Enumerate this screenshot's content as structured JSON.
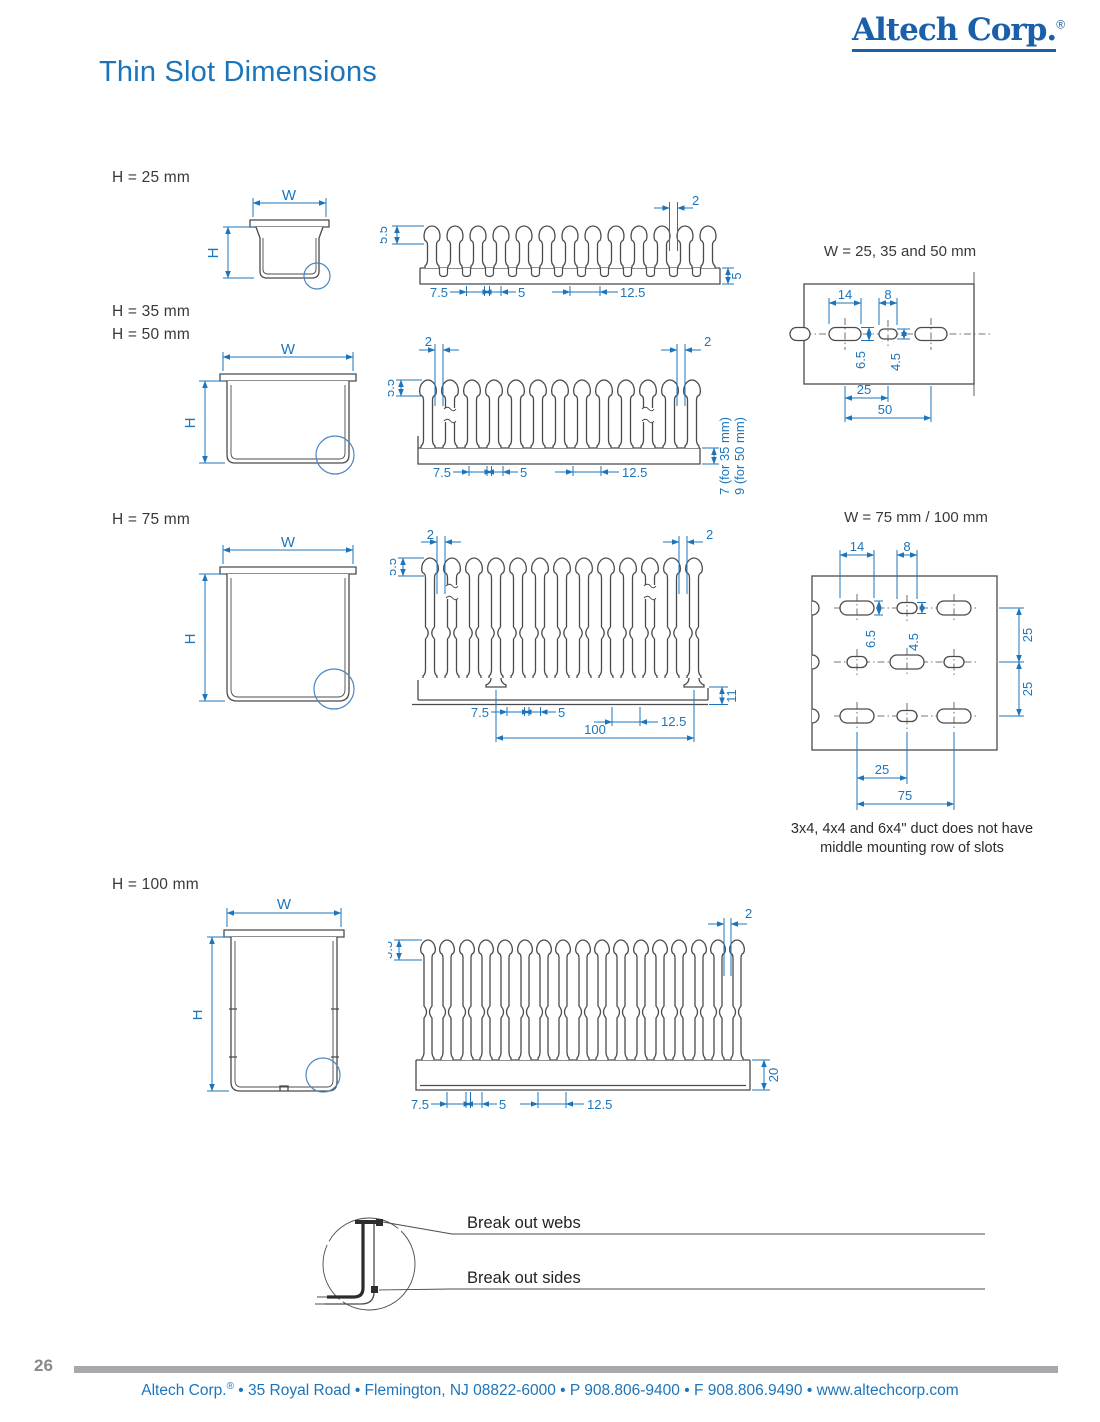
{
  "colors": {
    "accent_blue": "#1c75bb",
    "logo_blue": "#1a5fa9",
    "line_dark": "#4b4b4d",
    "footer_bar_gray": "#a7a9ac"
  },
  "header": {
    "logo": "Altech Corp.",
    "reg": "®",
    "title": "Thin Slot Dimensions"
  },
  "section_labels": {
    "h25": "H = 25 mm",
    "h35": "H = 35 mm",
    "h50": "H = 50 mm",
    "h75": "H = 75 mm",
    "h100": "H = 100 mm"
  },
  "axes": {
    "w": "W",
    "h": "H"
  },
  "profile25": {
    "top": "5.5",
    "slot": "2",
    "base": "5",
    "p1": "7.5",
    "p2": "5",
    "p3": "12.5"
  },
  "profile3550": {
    "top": "5.5",
    "slot_l": "2",
    "slot_r": "2",
    "p1": "7.5",
    "p2": "5",
    "p3": "12.5",
    "base35": "7 (for 35 mm)",
    "base50": "9 (for 50 mm)"
  },
  "profile75": {
    "top": "5.5",
    "slot_l": "2",
    "slot_r": "2",
    "foot": "11",
    "p1": "7.5",
    "p2": "5",
    "p3": "12.5",
    "span": "100"
  },
  "profile100": {
    "top": "5.5",
    "slot": "2",
    "base": "20",
    "p1": "7.5",
    "p2": "5",
    "p3": "12.5"
  },
  "mount_small": {
    "title": "W = 25, 35 and 50 mm",
    "d14": "14",
    "d8": "8",
    "d65": "6.5",
    "d45": "4.5",
    "d25": "25",
    "d50": "50"
  },
  "mount_large": {
    "title": "W = 75 mm / 100 mm",
    "d14": "14",
    "d8": "8",
    "d65": "6.5",
    "d45": "4.5",
    "row_a": "25",
    "row_b": "25",
    "col_a": "25",
    "col_b": "75",
    "note1": "3x4, 4x4 and 6x4\" duct does not have",
    "note2": "middle mounting row of slots"
  },
  "breakout": {
    "webs": "Break out webs",
    "sides": "Break out sides"
  },
  "footer": {
    "page": "26",
    "company": "Altech Corp.",
    "reg": "®",
    "address": " • 35 Royal Road • Flemington, NJ 08822-6000 • P 908.806-9400 • F 908.806.9490 • www.altechcorp.com"
  }
}
